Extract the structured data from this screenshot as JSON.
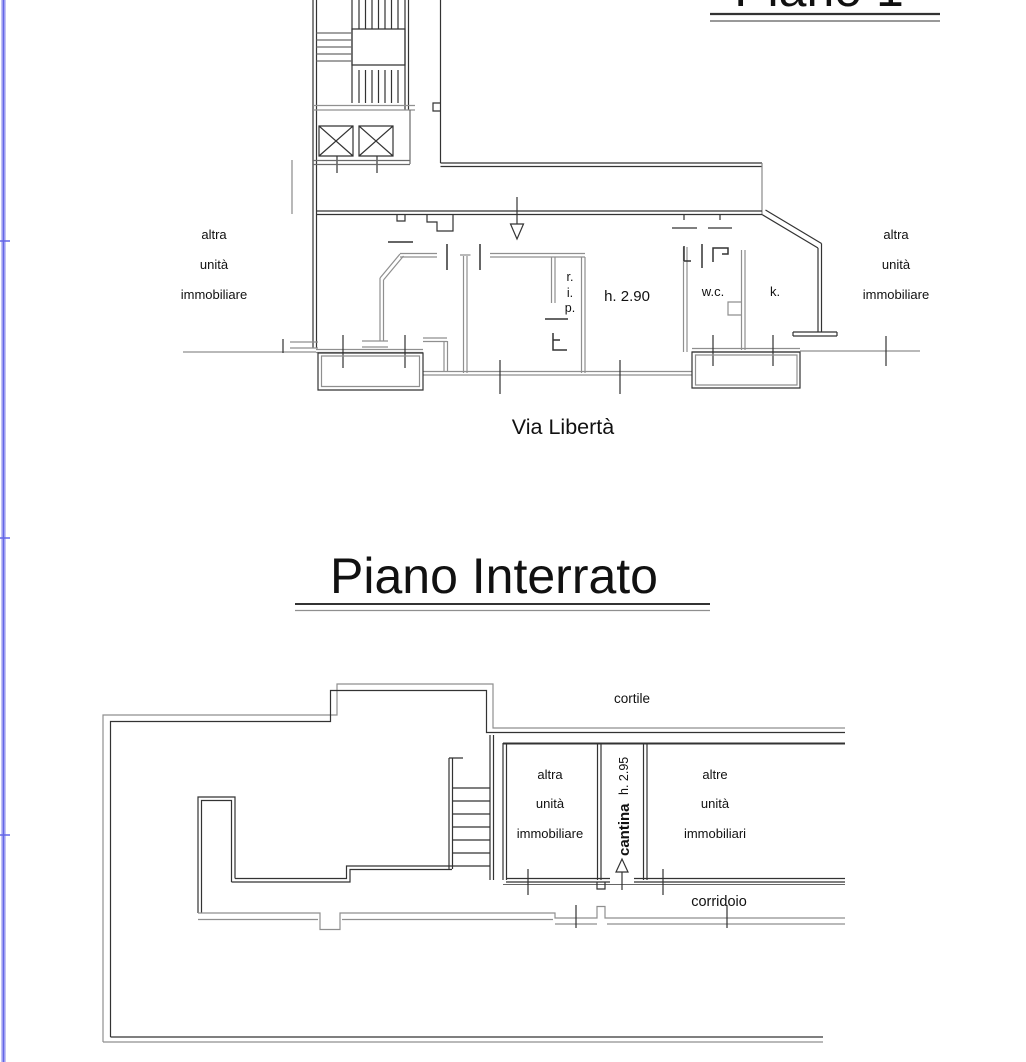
{
  "page": {
    "width": 1026,
    "height": 1062,
    "background": "#ffffff"
  },
  "border": {
    "color": "#6466e8"
  },
  "plan_upper": {
    "title": "Piano 1°",
    "street": "Via Libertà",
    "left_unit": {
      "line1": "altra",
      "line2": "unità",
      "line3": "immobiliare"
    },
    "right_unit": {
      "line1": "altra",
      "line2": "unità",
      "line3": "immobiliare"
    },
    "closet": {
      "line1": "r.",
      "line2": "i.",
      "line3": "p."
    },
    "height_note": "h. 2.90",
    "wc": "w.c.",
    "kitchen": "k."
  },
  "plan_basement": {
    "title": "Piano Interrato",
    "courtyard": "cortile",
    "left_unit": {
      "line1": "altra",
      "line2": "unità",
      "line3": "immobiliare"
    },
    "right_unit": {
      "line1": "altre",
      "line2": "unità",
      "line3": "immobiliari"
    },
    "cellar": "cantina",
    "cellar_height": "h. 2.95",
    "corridor": "corridoio"
  }
}
